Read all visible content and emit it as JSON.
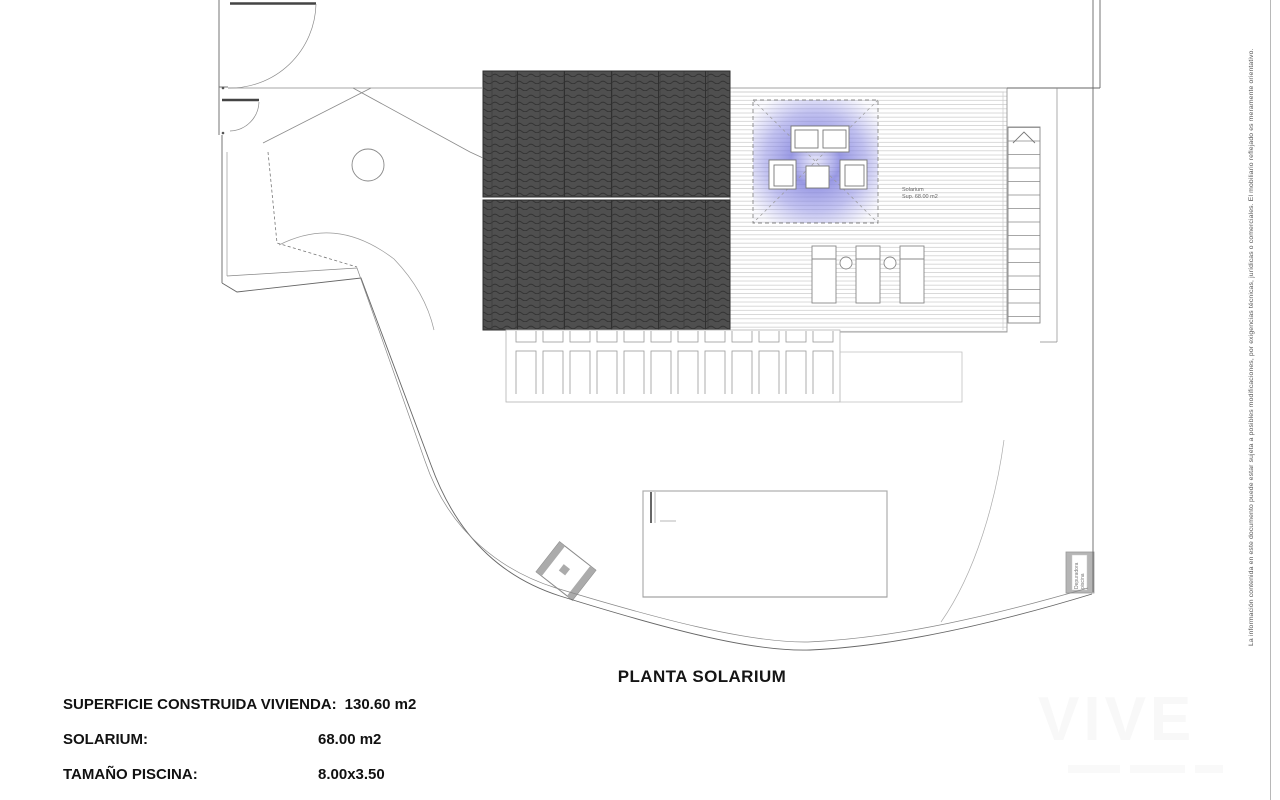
{
  "title": "PLANTA SOLARIUM",
  "legend": {
    "rows": [
      {
        "label": "SUPERFICIE CONSTRUIDA VIVIENDA:",
        "value": "130.60 m2"
      },
      {
        "label": "SOLARIUM:",
        "value": "68.00 m2"
      },
      {
        "label": "TAMAÑO PISCINA:",
        "value": "8.00x3.50"
      }
    ]
  },
  "plan": {
    "solarium_label_line1": "Solarium",
    "solarium_label_line2": "Sup. 68.00 m2",
    "equipment_box_line1": "Depuradora",
    "equipment_box_line2": "piscina"
  },
  "disclaimer": "La información contenida en este documento puede estar sujeta a posibles modificaciones, por exigencias técnicas, jurídicas o comerciales. El mobiliario reflejado es meramente orientativo.",
  "watermark": {
    "text": "VIVE"
  },
  "colors": {
    "roof_tile": "#4f4f4f",
    "pergola_glow": "#8080dd",
    "line_dark": "#555555",
    "line_light": "#c9c9c9"
  }
}
